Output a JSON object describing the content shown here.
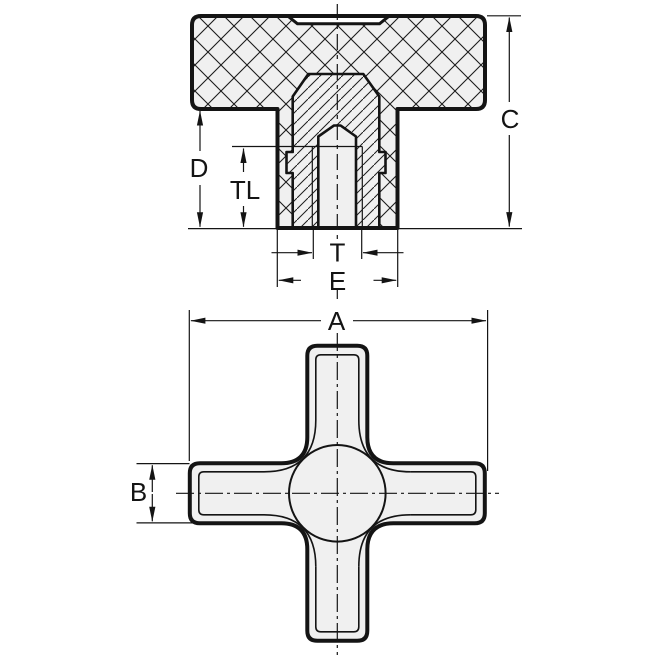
{
  "drawing": {
    "description": "two-view technical drawing of a cross knob with blind tapped insert",
    "background": "#ffffff",
    "line_color": "#141414",
    "part_fill": "#f0f0f0",
    "dims": {
      "A": "A",
      "B": "B",
      "C": "C",
      "D": "D",
      "E": "E",
      "T": "T",
      "TL": "TL"
    }
  }
}
